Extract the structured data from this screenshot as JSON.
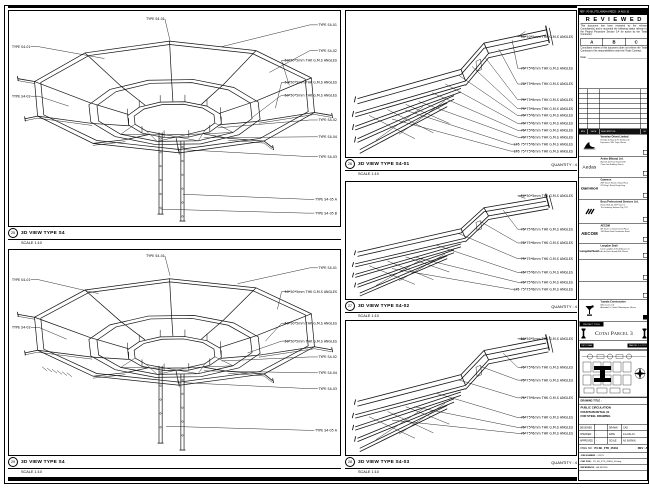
{
  "views": {
    "left_top": {
      "number": "25",
      "title": "3D VIEW TYPE S4",
      "scale": "SCALE 1:10",
      "quantity": "",
      "label_top": "TYPE S4-01",
      "labels_left": [
        "TYPE S4-01",
        "TYPE S4-02"
      ],
      "labels_right": [
        "TYPE S4-01",
        "TYPE S4-02",
        "50*50*5mm THK G.M.S ANGLES",
        "50*50*5mm THK G.M.S ANGLES",
        "50*50*5mm THK G.M.S ANGLES",
        "TYPE S4-02",
        "TYPE S4-04",
        "TYPE S4-03",
        "TYPE S4-05 A",
        "TYPE S4-05 B"
      ]
    },
    "left_bottom": {
      "number": "29",
      "title": "3D VIEW TYPE S4",
      "scale": "SCALE 1:10",
      "quantity": "",
      "label_top": "TYPE S4-01",
      "labels_left": [
        "TYPE S4-01",
        "TYPE S4-02"
      ],
      "labels_right": [
        "TYPE S4-01",
        "50*50*5mm THK G.M.S ANGLES",
        "50*50*5mm THK G.M.S ANGLES",
        "50*50*5mm THK G.M.S ANGLES",
        "TYPE S4-02",
        "TYPE S4-04",
        "TYPE S4-03",
        "TYPE S4-05 A"
      ]
    },
    "mid_top": {
      "number": "26",
      "title": "3D VIEW TYPE S4-01",
      "scale": "SCALE 1:10",
      "quantity": "QUANTITY : 4",
      "labels_right": [
        "50*50*5mm THK G.M.S ANGLES",
        "75*75*6mm THK G.M.S ANGLES",
        "75*75*6mm THK G.M.S ANGLES",
        "75*75*6mm THK G.M.S ANGLES",
        "75*75*6mm THK G.M.S ANGLES",
        "75*75*6mm THK G.M.S ANGLES",
        "75*75*6mm THK G.M.S ANGLES",
        "75*75*6mm THK G.M.S ANGLES",
        "75*75*6mm THK G.M.S ANGLES",
        "L75 75*75*6mm THK G.M.S ANGLES",
        "L75 75*75*6mm THK G.M.S ANGLES"
      ]
    },
    "mid_middle": {
      "number": "27",
      "title": "3D VIEW TYPE S4-02",
      "scale": "SCALE 1:10",
      "quantity": "QUANTITY : 4",
      "labels_right": [
        "50*50*5mm THK G.M.S ANGLES",
        "75*75*6mm THK G.M.S ANGLES",
        "75*75*6mm THK G.M.S ANGLES",
        "75*75*6mm THK G.M.S ANGLES",
        "75*75*6mm THK G.M.S ANGLES",
        "75*75*6mm THK G.M.S ANGLES",
        "L75 75*75*6mm THK G.M.S ANGLES"
      ]
    },
    "mid_bottom": {
      "number": "28",
      "title": "3D VIEW TYPE S4-03",
      "scale": "SCALE 1:10",
      "quantity": "QUANTITY : 4",
      "labels_right": [
        "50*50*5mm THK G.M.S ANGLES",
        "75*75*6mm THK G.M.S ANGLES",
        "75*75*6mm THK G.M.S ANGLES",
        "75*75*6mm THK G.M.S ANGLES",
        "75*75*6mm THK G.M.S ANGLES",
        "75*75*6mm THK G.M.S ANGLES",
        "75*75*6mm THK G.M.S ANGLES"
      ]
    }
  },
  "title_block": {
    "doc_bar": "REF : P3-SK_FTD_45434-A    RECD : 14 AUG 10",
    "reviewed": {
      "title": "R E V I E W E D",
      "body1": "This document has been reviewed by the relevant Consultant(s) and is accorded the following status relevant to the Project Procedure Section 5.4 for action by the Trade Contractor.",
      "statuses": [
        "A",
        "B",
        "C"
      ],
      "body2": "Consultant review of this document does not relieve the Trade Contractor of its responsibilities under the Trade Contract.",
      "date_label": "Date :"
    },
    "rev_table": {
      "headers": [
        "REV",
        "DATE",
        "DESCRIPTION",
        "BY"
      ]
    },
    "companies": [
      {
        "name": "Venetian Orient Limited",
        "l1": "Estrada da Baia de N. Senhora da",
        "l2": "Esperanca, S/N, Taipa, Macau"
      },
      {
        "logo_text": "Aedas",
        "name": "Aedas (Macau) Ltd.",
        "l1": "Avenida da Praia Grande 409",
        "l2": "China Law Building, Macau"
      },
      {
        "logo_text": "Gammon",
        "name": "Gammon",
        "l1": "28/F Devon House, Taikoo Place",
        "l2": "979 King's Road, Hong Kong"
      },
      {
        "name": "Beca Professional Services Ltd.",
        "l1": "Room 2301-03, 23/F Tower 1",
        "l2": "The Gateway, Harbour City, TST"
      },
      {
        "logo_text": "AECOM",
        "name": "AECOM",
        "l1": "8/F Tower 2, Grand Central Plaza",
        "l2": "138 Shatin Rural Committee Road"
      },
      {
        "logo_text": "LangdonSeah",
        "name": "Langdon Seah",
        "l1": "Davis Langdon & Seah Macau Ltd",
        "l2": "Av. da Praia Grande 409, Macau"
      },
      {
        "name": "",
        "l1": "",
        "l2": ""
      },
      {
        "name": "",
        "l1": "",
        "l2": ""
      },
      {
        "name": "Yuanda Construction",
        "l1": "(Macau) Co. Ltd.",
        "l2": "Alameda Dr. Carlos D'Assumpcao, Macau"
      }
    ],
    "project": {
      "label": "PROJECT TITLE",
      "name": "Cotai Parcel 3"
    },
    "key_plan": {
      "label": "KEY PLAN",
      "zone": "PARCEL 1, LOT 2"
    },
    "drawing_title": {
      "label": "DRAWING TITLE :",
      "lines": [
        "PUBLIC CIRCULATION",
        "FOUNTAIN DETAIL 31",
        "FOR STEEL DRAWING"
      ]
    },
    "approvals": {
      "rows": [
        [
          "DESIGNED",
          "",
          "DRAWN",
          "CAD"
        ],
        [
          "CHECKED",
          "-",
          "DATE",
          "14-AUG-10"
        ],
        [
          "APPROVED",
          "-",
          "SCALE",
          "AS SHOWN"
        ]
      ]
    },
    "dwg": {
      "label": "DWG NO :",
      "value": "P3-SK_FTD_45434",
      "rev": "REV : A"
    },
    "job": {
      "label": "JOB NUMBER :",
      "value": "21123"
    },
    "cad": {
      "label": "CAD FILE :",
      "value": "P3_SK_FTD_45434_S4.dwg"
    },
    "reference": {
      "label": "REFERENCE :",
      "value": "AS NOTED"
    }
  }
}
